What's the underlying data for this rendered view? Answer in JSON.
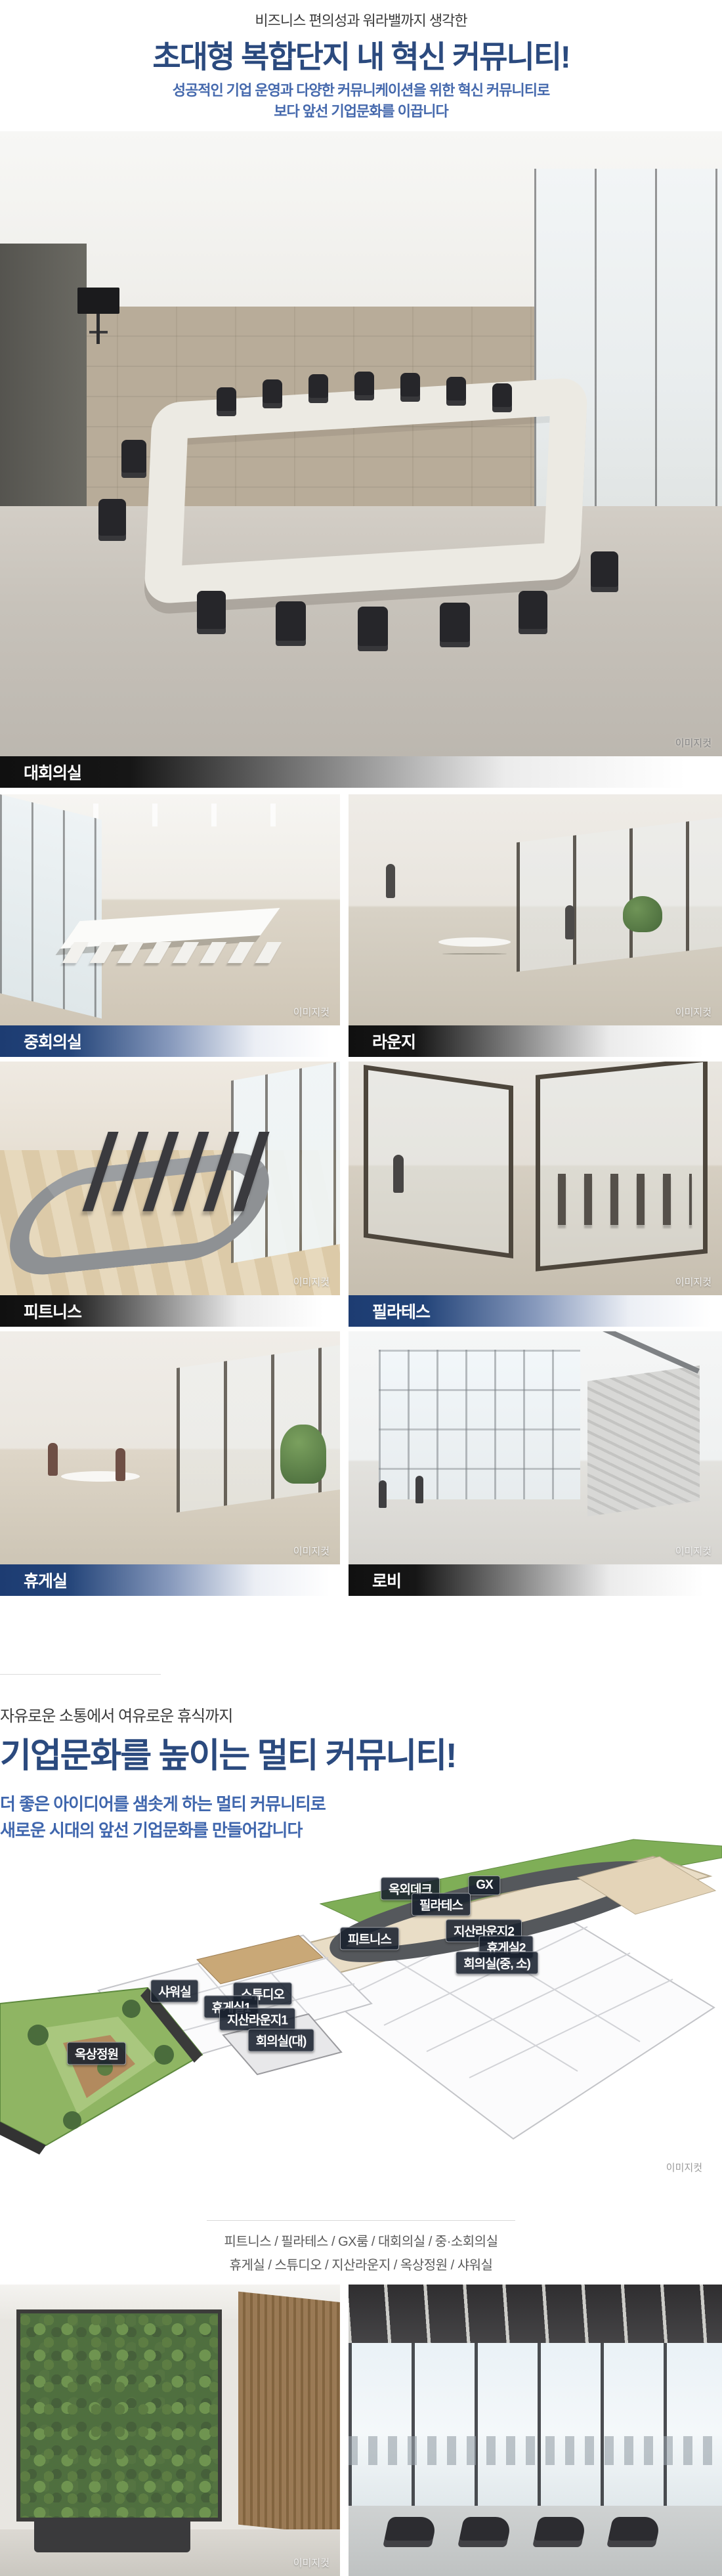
{
  "intro": {
    "eyebrow": "비즈니스 편의성과 워라밸까지 생각한",
    "title": "초대형 복합단지 내 혁신 커뮤니티!",
    "subtitle_line1": "성공적인 기업 운영과 다양한 커뮤니케이션을 위한 혁신 커뮤니티로",
    "subtitle_line2": "보다 앞선 기업문화를 이끕니다"
  },
  "watermark": "이미지컷",
  "hero": {
    "label": "대회의실"
  },
  "gallery": {
    "items": [
      {
        "label": "중회의실",
        "theme": "blue"
      },
      {
        "label": "라운지",
        "theme": "dark"
      },
      {
        "label": "피트니스",
        "theme": "dark"
      },
      {
        "label": "필라테스",
        "theme": "blue"
      },
      {
        "label": "휴게실",
        "theme": "blue"
      },
      {
        "label": "로비",
        "theme": "dark"
      }
    ]
  },
  "section2": {
    "eyebrow": "자유로운 소통에서 여유로운 휴식까지",
    "title": "기업문화를 높이는 멀티 커뮤니티!",
    "subtitle_line1": "더 좋은 아이디어를 샘솟게 하는 멀티 커뮤니티로",
    "subtitle_line2": "새로운 시대의 앞선 기업문화를 만들어갑니다"
  },
  "floorplan": {
    "labels": [
      "옥외데크",
      "GX",
      "필라테스",
      "피트니스",
      "지산라운지2",
      "휴게실2",
      "회의실(중, 소)",
      "샤워실",
      "스튜디오",
      "휴게실1",
      "지산라운지1",
      "회의실(대)",
      "옥상정원"
    ]
  },
  "caption": {
    "line1": "피트니스 / 필라테스 / GX룸 / 대회의실 / 중·소회의실",
    "line2": "휴게실 / 스튜디오 / 지산라운지 / 옥상정원 / 샤워실"
  },
  "colors": {
    "title_navy": "#2b4a7e",
    "subtitle_blue": "#4569ad",
    "bar_blue": "#1d3c72",
    "bar_dark": "#101010",
    "badge_bg": "#18202e"
  }
}
